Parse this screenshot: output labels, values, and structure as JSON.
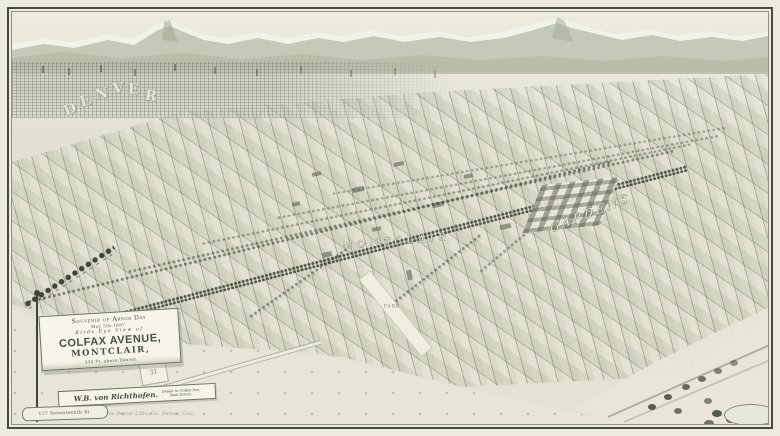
{
  "palette": {
    "paper": "#edebdc",
    "ground": "#e2e1d1",
    "ink": "#4a4e42",
    "mountain": "#c4cab7",
    "snow": "#f3f4ea",
    "foothill": "#b6bca8",
    "tree": "#404736",
    "banner": "#f7f5e9"
  },
  "map_labels": {
    "city": "DENVER",
    "city_letters": [
      "D",
      "E",
      "N",
      "V",
      "E",
      "R"
    ],
    "town": "MONTCLAIR",
    "district": "GARDENS",
    "park": "PARK",
    "plaque": "31"
  },
  "cartouche": {
    "line1": "Souvenir of Arbor Day",
    "line2": "May 5th 1887.",
    "line3": "Birds Eye View of",
    "line4": "COLFAX AVENUE,",
    "line5": "MONTCLAIR,",
    "line6": "330 Ft. above Denver."
  },
  "dealer_ribbon": {
    "name": "W.B. von Richthofen.",
    "line1": "Dealer in Colfax Ave.",
    "line2": "Real Estate."
  },
  "address_ribbon": {
    "text": "117 Seventeenth St."
  },
  "imprint": {
    "text": "The Denver Litho. Co., Denver, Colo."
  }
}
